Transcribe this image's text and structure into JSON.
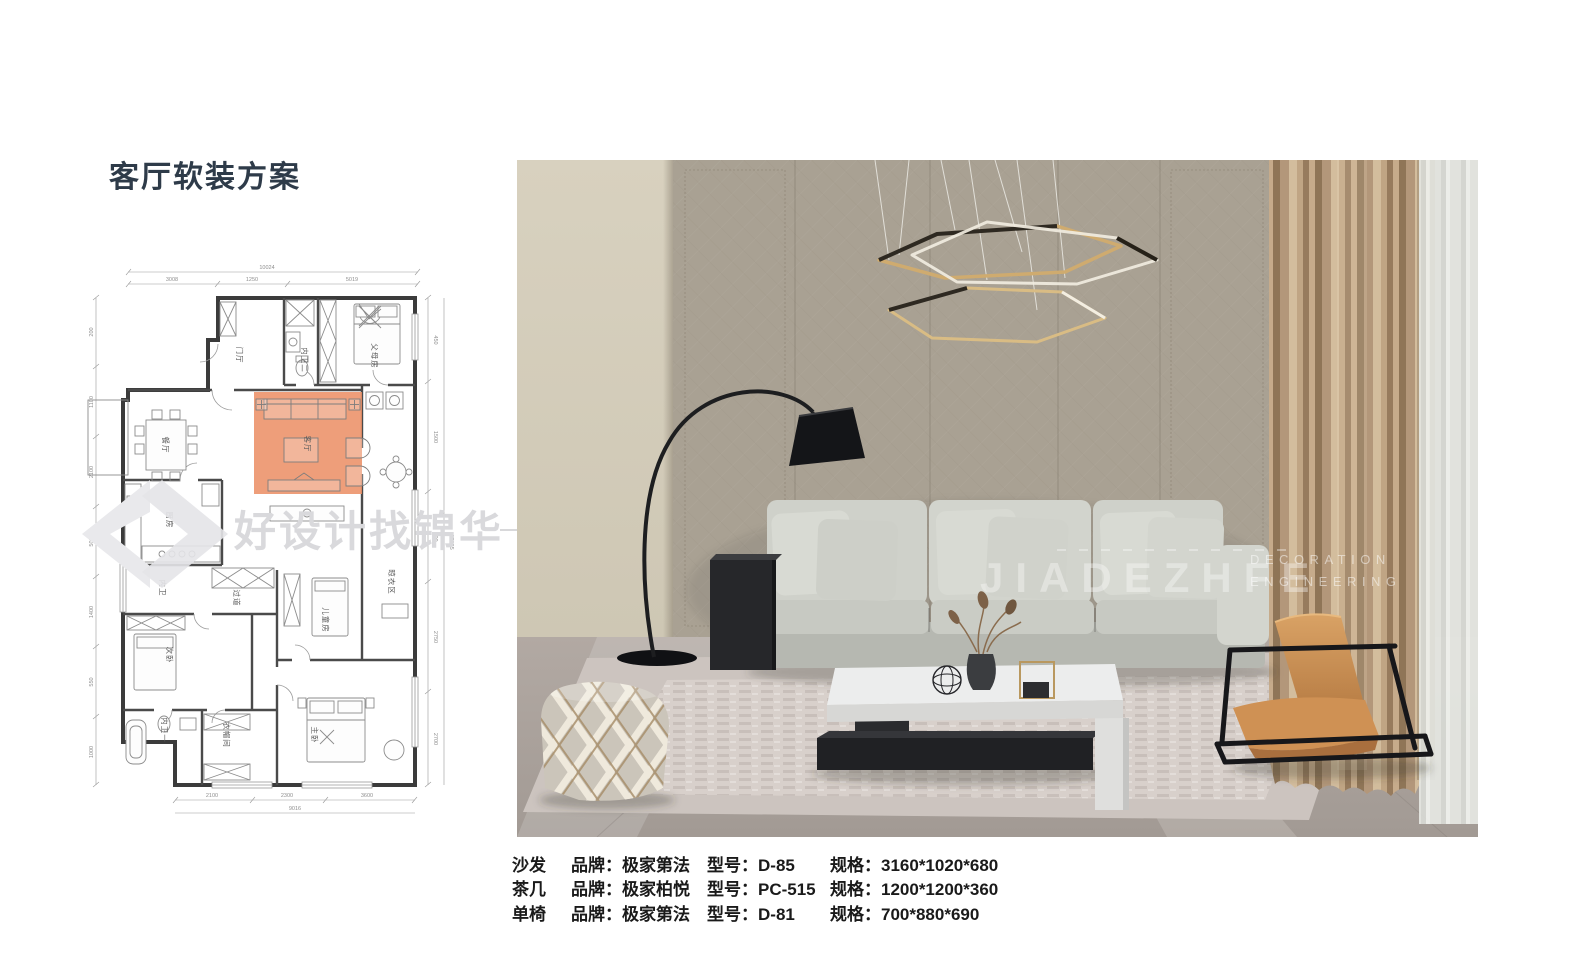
{
  "page": {
    "title": "客厅软装方案"
  },
  "colors": {
    "title": "#2e3b49",
    "highlight_orange": "#ec9168",
    "curtain_champagne": "#b3977a",
    "chair_tan": "#cf9154",
    "watermark_gray": "#dadadc"
  },
  "watermark": {
    "cn": "好设计找锦华",
    "en_main": "JIADEZHFE",
    "en_line1": "DECORATION",
    "en_line2": "ENGINEERING"
  },
  "floorplan": {
    "rooms": [
      {
        "name": "门厅"
      },
      {
        "name": "内卫二"
      },
      {
        "name": "父母房"
      },
      {
        "name": "餐厅"
      },
      {
        "name": "客厅"
      },
      {
        "name": "厨房"
      },
      {
        "name": "内卫"
      },
      {
        "name": "过道"
      },
      {
        "name": "儿童房"
      },
      {
        "name": "晾衣区"
      },
      {
        "name": "次卧"
      },
      {
        "name": "内卫一"
      },
      {
        "name": "衣帽间"
      },
      {
        "name": "主卧"
      }
    ],
    "dims": {
      "top_total": "10024",
      "top_segments": [
        "3008",
        "1250",
        "5019"
      ],
      "bottom_total": "9016",
      "bottom_segments": [
        "2100",
        "2300",
        "3600"
      ],
      "left_segments": [
        "200",
        "1100",
        "2100",
        "500",
        "1400",
        "550",
        "1000"
      ],
      "right_segments": [
        "450",
        "1500",
        "600",
        "2750",
        "2700"
      ],
      "right_total": "17195"
    }
  },
  "specs": {
    "labels": {
      "brand": "品牌：",
      "model": "型号：",
      "size": "规格："
    },
    "rows": [
      {
        "item": "沙发",
        "brand": "极家第法",
        "model": "D-85",
        "size": "3160*1020*680"
      },
      {
        "item": "茶几",
        "brand": "极家柏悦",
        "model": "PC-515",
        "size": "1200*1200*360"
      },
      {
        "item": "单椅",
        "brand": "极家第法",
        "model": "D-81",
        "size": "700*880*690"
      }
    ]
  }
}
